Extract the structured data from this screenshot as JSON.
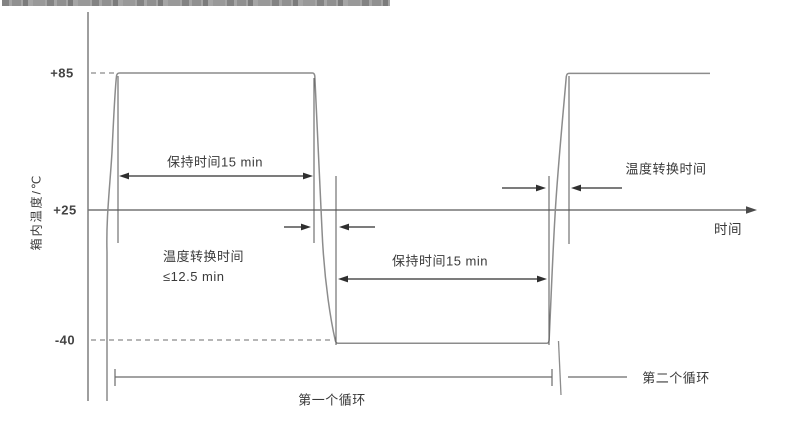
{
  "diagram": {
    "y_axis_label": "箱内温度/℃",
    "x_axis_label": "时间",
    "ticks": {
      "high": "+85",
      "ambient": "+25",
      "low": "-40"
    },
    "annotations": {
      "hold_time_top": "保持时间15 min",
      "hold_time_bottom": "保持时间15 min",
      "transition_left_line1": "温度转换时间",
      "transition_left_line2": "≤12.5 min",
      "transition_right": "温度转换时间",
      "cycle_first": "第一个循环",
      "cycle_second": "第二个循环"
    },
    "colors": {
      "curve": "#8c8c8c",
      "axis": "#757575",
      "dimension": "#555555",
      "arrow": "#2f2f2f",
      "text": "#3a3a3a",
      "background": "#ffffff"
    }
  }
}
